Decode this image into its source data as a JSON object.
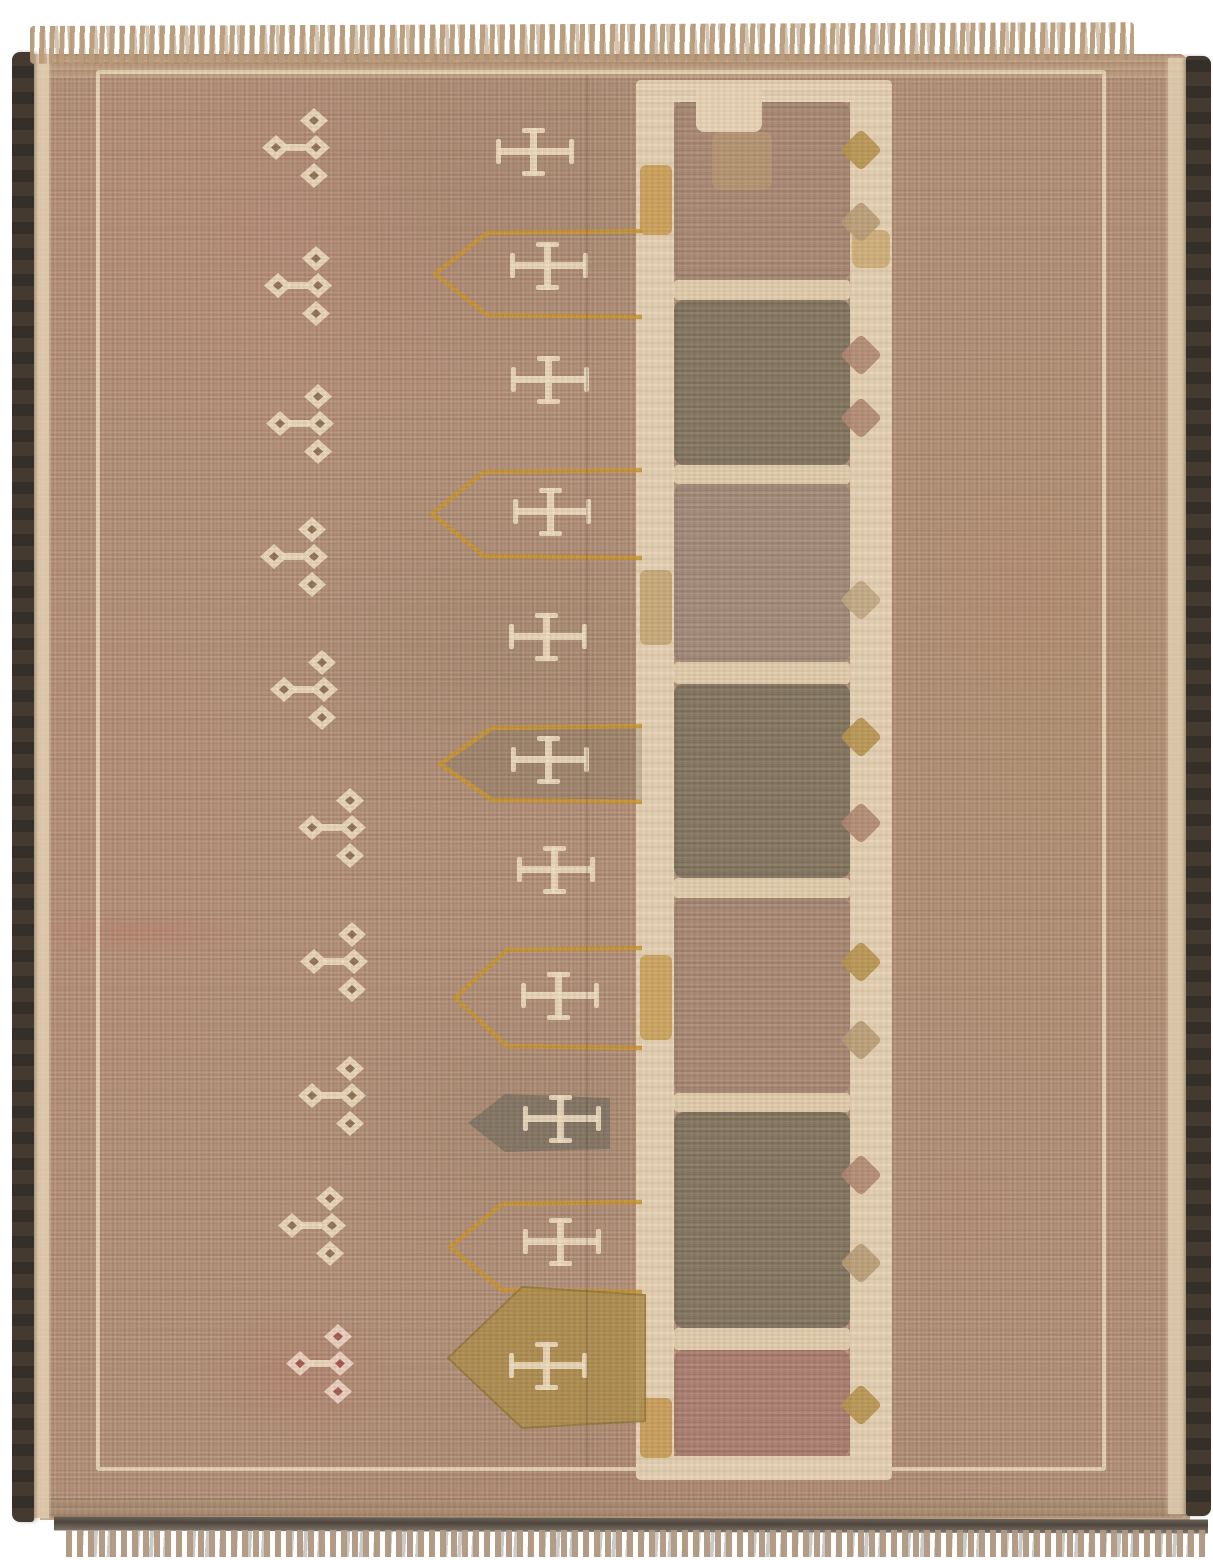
{
  "scene": {
    "description": "Photograph of a vintage hand-knotted tribal rug on a white background. Faded camel-tan and rose-brown field, dark brown selvedge on left and right edges, tan fringe at top and bottom. A thin cream border line frames the field. A column of ten small cream diamond-cluster motifs runs down the left, a column of eleven cream crosses runs down the middle (several enclosed by orange arrow-shaped outlines, one on a gold filled arrow, one on a dark filled arrow), and a cream ladder of stacked rectangular panels in alternating mauve-pink and dark olive-grey runs down the right of center, dotted with small gold, tan and mauve diamonds.",
    "background_color": "#ffffff"
  },
  "palette": {
    "field": "#b28f78",
    "field_pink": "#c58176",
    "field_tan": "#b08e64",
    "cream": "#ead9bb",
    "ladder_cream": "#e6d3b7",
    "orange": "#c6932f",
    "gold_fill": "#ac8c49",
    "dark_fill": "#7a7060",
    "selvedge_dark": "#3e362e",
    "fringe_tan": "#b89b78",
    "red_accent": "#b25a55",
    "tones": {
      "mauve": "#a88874",
      "dark": "#81745f",
      "mauve_gray": "#a38a7a",
      "pink": "#ab7e70",
      "gold": "#b5924d",
      "tan": "#b79b74",
      "tan_faint": "#bfa682",
      "mauve_dia": "#ae8672",
      "cream": "#e6d3b6"
    }
  },
  "ladder": {
    "panels": [
      {
        "y1": 102,
        "y2": 280,
        "tone": "mauve"
      },
      {
        "y1": 300,
        "y2": 465,
        "tone": "dark"
      },
      {
        "y1": 484,
        "y2": 662,
        "tone": "mauve_gray"
      },
      {
        "y1": 684,
        "y2": 878,
        "tone": "dark"
      },
      {
        "y1": 898,
        "y2": 1093,
        "tone": "mauve"
      },
      {
        "y1": 1112,
        "y2": 1328,
        "tone": "dark"
      },
      {
        "y1": 1350,
        "y2": 1456,
        "tone": "pink"
      }
    ],
    "rungs": [
      {
        "y": 280,
        "h": 20
      },
      {
        "y": 465,
        "h": 19
      },
      {
        "y": 662,
        "h": 22
      },
      {
        "y": 878,
        "h": 20
      },
      {
        "y": 1093,
        "h": 19
      },
      {
        "y": 1328,
        "h": 22
      }
    ],
    "left_band_patches": [
      {
        "y": 165,
        "h": 70,
        "c": "#c79545"
      },
      {
        "y": 570,
        "h": 75,
        "c": "#bfa06a"
      },
      {
        "y": 955,
        "h": 85,
        "c": "#c59a4a"
      },
      {
        "y": 1398,
        "h": 60,
        "c": "#c29245"
      }
    ],
    "top_blobs": [
      {
        "x": 696,
        "y": 84,
        "w": 66,
        "h": 48,
        "c": "#e6d3b6"
      },
      {
        "x": 712,
        "y": 132,
        "w": 60,
        "h": 58,
        "c": "rgba(189,157,111,0.55)"
      },
      {
        "x": 852,
        "y": 230,
        "w": 38,
        "h": 38,
        "c": "rgba(192,154,85,0.6)"
      }
    ],
    "right_band_diamonds": [
      {
        "y": 150,
        "tone": "gold"
      },
      {
        "y": 222,
        "tone": "tan"
      },
      {
        "y": 355,
        "tone": "mauve_dia"
      },
      {
        "y": 418,
        "tone": "mauve_dia"
      },
      {
        "y": 600,
        "tone": "tan_faint"
      },
      {
        "y": 737,
        "tone": "gold"
      },
      {
        "y": 823,
        "tone": "mauve_dia"
      },
      {
        "y": 962,
        "tone": "gold"
      },
      {
        "y": 1040,
        "tone": "tan"
      },
      {
        "y": 1175,
        "tone": "mauve_dia"
      },
      {
        "y": 1263,
        "tone": "tan"
      },
      {
        "y": 1405,
        "tone": "gold"
      }
    ]
  },
  "motifs": {
    "diamond_clusters": [
      {
        "x": 262,
        "y": 108
      },
      {
        "x": 264,
        "y": 246
      },
      {
        "x": 266,
        "y": 384
      },
      {
        "x": 260,
        "y": 517
      },
      {
        "x": 270,
        "y": 650
      },
      {
        "x": 298,
        "y": 788
      },
      {
        "x": 300,
        "y": 922
      },
      {
        "x": 298,
        "y": 1056
      },
      {
        "x": 278,
        "y": 1186
      },
      {
        "x": 286,
        "y": 1324,
        "red": true
      }
    ],
    "crosses": [
      {
        "cx": 535,
        "cy": 152
      },
      {
        "cx": 549,
        "cy": 266
      },
      {
        "cx": 550,
        "cy": 380
      },
      {
        "cx": 552,
        "cy": 512
      },
      {
        "cx": 548,
        "cy": 637
      },
      {
        "cx": 550,
        "cy": 760
      },
      {
        "cx": 556,
        "cy": 870
      },
      {
        "cx": 560,
        "cy": 996
      },
      {
        "cx": 562,
        "cy": 1119
      },
      {
        "cx": 562,
        "cy": 1242
      },
      {
        "cx": 548,
        "cy": 1366
      }
    ],
    "arrow_outlines": [
      {
        "y1": 231,
        "y2": 317,
        "xp": 435,
        "xr": 642
      },
      {
        "y1": 470,
        "y2": 558,
        "xp": 432,
        "xr": 642
      },
      {
        "y1": 726,
        "y2": 802,
        "xp": 440,
        "xr": 642,
        "fill": "rgba(112,102,80,0.30)"
      },
      {
        "y1": 948,
        "y2": 1048,
        "xp": 455,
        "xr": 642
      },
      {
        "y1": 1202,
        "y2": 1292,
        "xp": 450,
        "xr": 642
      }
    ],
    "arrows_filled": [
      {
        "pts": "610,1098 505,1094 468,1123 505,1152 610,1149",
        "c": "#7a7060",
        "op": 0.85
      },
      {
        "pts": "645,1295 522,1287 448,1358 522,1428 645,1421",
        "c": "#ac8c49",
        "op": 0.85,
        "stroke": "#8f7536"
      }
    ],
    "faint_blotches": [
      {
        "x": 920,
        "y": 470,
        "w": 200,
        "h": 240,
        "c": "rgba(186,118,108,0.12)"
      },
      {
        "x": 880,
        "y": 1120,
        "w": 170,
        "h": 190,
        "c": "rgba(186,118,108,0.10)"
      },
      {
        "x": 196,
        "y": 1296,
        "w": 210,
        "h": 150,
        "c": "rgba(178,90,85,0.20)"
      }
    ]
  }
}
